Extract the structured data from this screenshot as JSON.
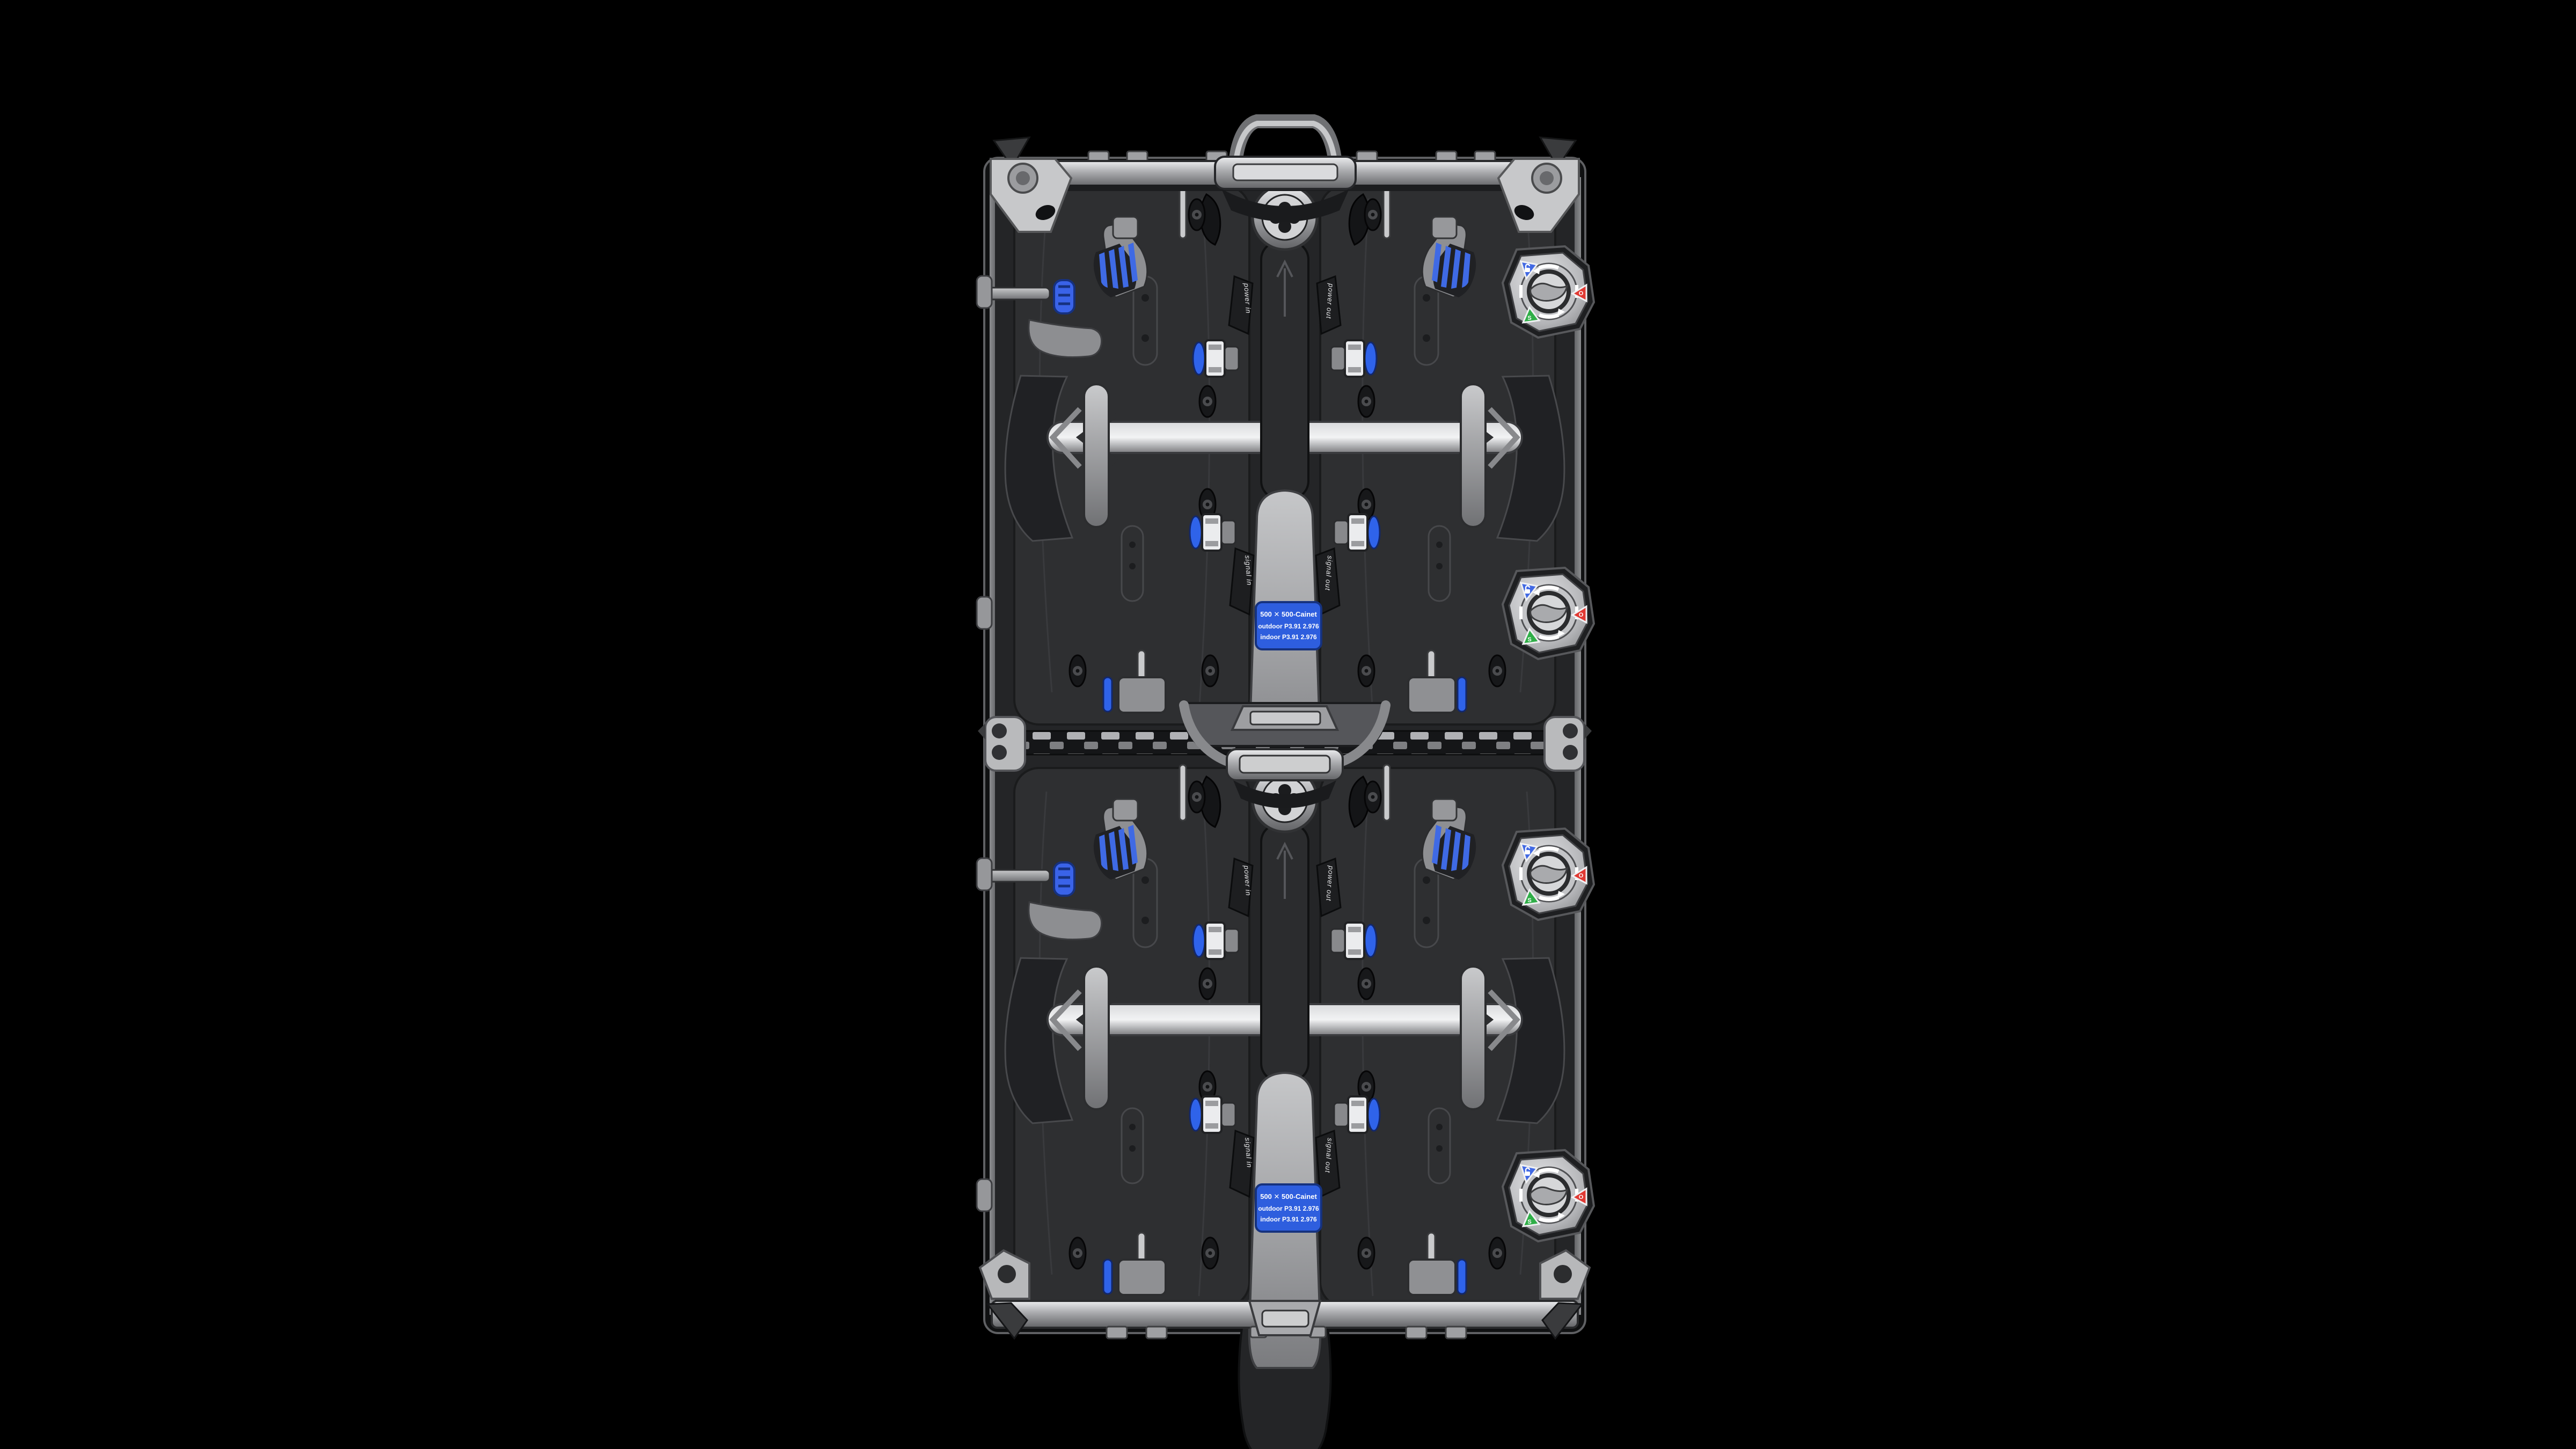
{
  "scene": {
    "type": "product-render",
    "description": "Rear view of two vertically stacked LED display cabinets (video wall panels) on a black background",
    "background_color": "#000000"
  },
  "cabinet": {
    "spine_labels": {
      "power_in": "power in",
      "power_out": "power out",
      "signal_in": "signal in",
      "signal_out": "signal out"
    },
    "spec_label": {
      "line1": "500 ✕ 500-Cainet",
      "line2": "outdoor P3.91 2.976",
      "line3": "indoor P3.91 2.976",
      "bg_color": "#2e5ede",
      "text_color": "#ffffff"
    },
    "lock_dial": {
      "count": 4,
      "indicators": [
        {
          "name": "unlock",
          "color": "#4169e3",
          "glyph": ""
        },
        {
          "name": "open",
          "color": "#e03a34",
          "glyph": "O"
        },
        {
          "name": "safe",
          "color": "#2fae47",
          "glyph": "S"
        }
      ]
    },
    "colors": {
      "metal_light": "#e8e9eb",
      "metal_mid": "#9a9b9e",
      "metal_dark": "#5f6063",
      "shell_dark": "#242527",
      "plate_dark": "#2e2f31",
      "accent_blue": "#3a63e8",
      "indicator_red": "#e03a34",
      "indicator_green": "#2fae47",
      "indicator_blue": "#4169e3"
    }
  }
}
